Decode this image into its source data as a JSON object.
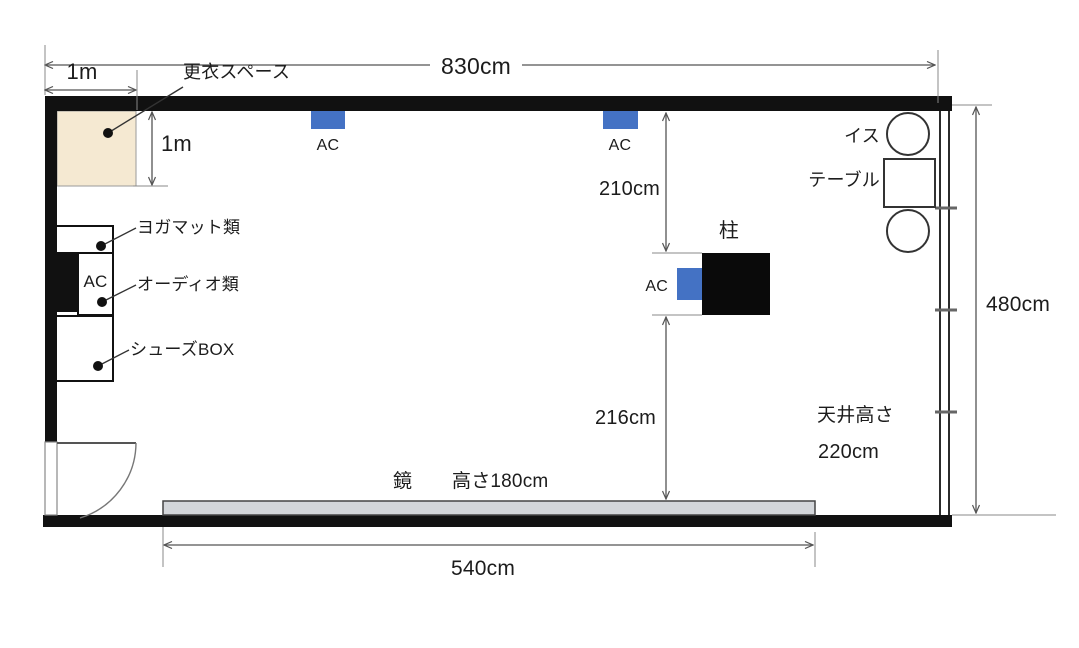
{
  "diagram": {
    "type": "floor-plan",
    "room": {
      "width_label": "830cm",
      "depth_label": "480cm",
      "ceiling_label_line1": "天井高さ",
      "ceiling_label_line2": "220cm"
    },
    "changing_space": {
      "label": "更衣スペース",
      "width_label": "1m",
      "depth_label": "1m"
    },
    "ac_label": "AC",
    "storage": {
      "yoga_mats": "ヨガマット類",
      "audio": "オーディオ類",
      "shoe_box": "シューズBOX"
    },
    "pillar": {
      "label": "柱",
      "front_clearance_label": "210cm",
      "back_clearance_label": "216cm"
    },
    "furniture": {
      "chair": "イス",
      "table": "テーブル"
    },
    "mirror": {
      "label": "鏡",
      "height_label": "高さ180cm",
      "width_label": "540cm"
    },
    "colors": {
      "ac_blue": "#4472c4",
      "changing_space_fill": "#f5e9d2",
      "mirror_fill": "#d3d6da",
      "wall": "#111111"
    }
  }
}
